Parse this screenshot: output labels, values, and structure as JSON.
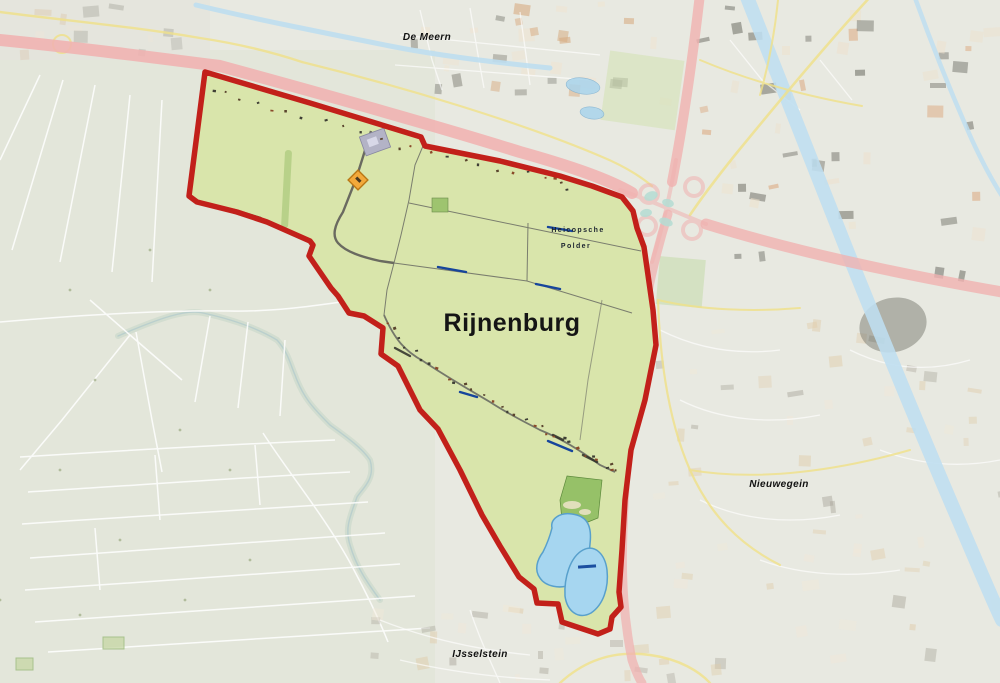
{
  "map": {
    "region_label": "Rijnenburg",
    "labels": {
      "de_meern": "De Meern",
      "heicopsche_line1": "Heicopsche",
      "heicopsche_line2": "Polder",
      "rijnenburg": "Rijnenburg",
      "nieuwegein": "Nieuwegein",
      "ijsselstein": "IJsselstein"
    },
    "colors": {
      "background": "#e8e9e1",
      "polder_tint": "#e0e5d6",
      "area_green": "#d9e5ab",
      "boundary_red": "#c2201a",
      "lake_blue": "#a6d6f0",
      "lake_edge": "#58a0cc",
      "motorway_pink": "#f0b2b0",
      "road_yellow": "#f0e188",
      "canal_blue": "#bedef0",
      "recreation_green": "#96c168",
      "field_line": "#7a7d6e",
      "water_dash_blue": "#16459c"
    }
  }
}
